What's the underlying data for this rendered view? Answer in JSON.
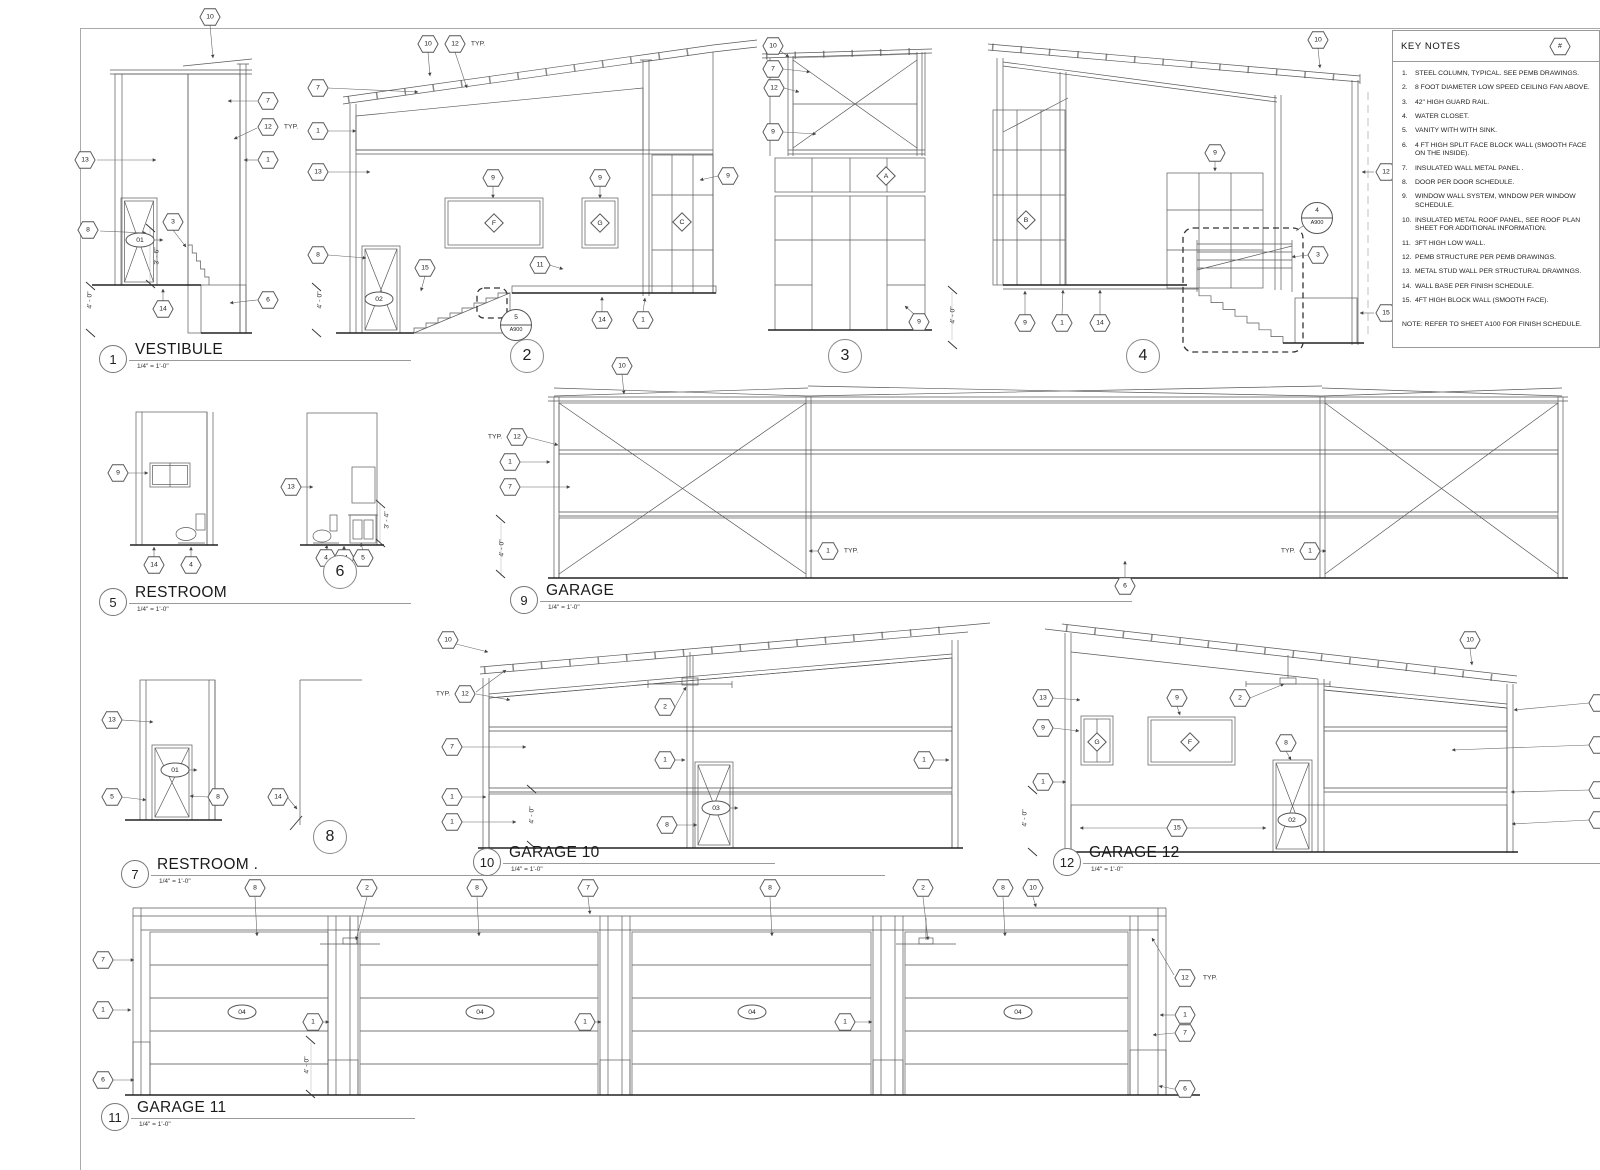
{
  "sheet": {
    "background": "#ffffff",
    "line_color": "#5a5a5a"
  },
  "key_notes": {
    "title": "KEY NOTES",
    "ref_symbol": "#",
    "items": [
      {
        "n": "1.",
        "text": "STEEL COLUMN, TYPICAL. SEE PEMB DRAWINGS."
      },
      {
        "n": "2.",
        "text": "8 FOOT DIAMETER LOW SPEED CEILING FAN ABOVE."
      },
      {
        "n": "3.",
        "text": "42\" HIGH  GUARD RAIL."
      },
      {
        "n": "4.",
        "text": "WATER CLOSET."
      },
      {
        "n": "5.",
        "text": "VANITY WITH WITH SINK."
      },
      {
        "n": "6.",
        "text": "4 FT HIGH SPLIT FACE BLOCK WALL (SMOOTH FACE ON THE INSIDE)."
      },
      {
        "n": "7.",
        "text": "INSULATED WALL METAL PANEL ."
      },
      {
        "n": "8.",
        "text": "DOOR  PER DOOR SCHEDULE."
      },
      {
        "n": "9.",
        "text": "WINDOW WALL SYSTEM, WINDOW PER WINDOW SCHEDULE."
      },
      {
        "n": "10.",
        "text": "INSULATED METAL ROOF PANEL, SEE ROOF PLAN SHEET FOR ADDITIONAL INFORMATION."
      },
      {
        "n": "11.",
        "text": "3FT HIGH LOW WALL."
      },
      {
        "n": "12.",
        "text": "PEMB STRUCTURE PER PEMB DRAWINGS."
      },
      {
        "n": "13.",
        "text": "METAL STUD WALL PER STRUCTURAL DRAWINGS."
      },
      {
        "n": "14.",
        "text": "WALL BASE PER FINISH SCHEDULE."
      },
      {
        "n": "15.",
        "text": "4FT HIGH BLOCK WALL (SMOOTH FACE)."
      }
    ],
    "footnote": "NOTE: REFER TO SHEET A100 FOR FINISH SCHEDULE."
  },
  "titles": [
    {
      "num": "1",
      "label": "VESTIBULE",
      "scale": "1/4\" = 1'-0\"",
      "x": 99,
      "y": 341,
      "w": 312
    },
    {
      "num": "5",
      "label": "RESTROOM",
      "scale": "1/4\" = 1'-0\"",
      "x": 99,
      "y": 584,
      "w": 312
    },
    {
      "num": "7",
      "label": "RESTROOM .",
      "scale": "1/4\" = 1'-0\"",
      "x": 121,
      "y": 856,
      "w": 764
    },
    {
      "num": "9",
      "label": "GARAGE",
      "scale": "1/4\" = 1'-0\"",
      "x": 510,
      "y": 582,
      "w": 622
    },
    {
      "num": "10",
      "label": "GARAGE 10",
      "scale": "1/4\" = 1'-0\"",
      "x": 473,
      "y": 844,
      "w": 302
    },
    {
      "num": "12",
      "label": "GARAGE 12",
      "scale": "1/4\" = 1'-0\"",
      "x": 1053,
      "y": 844,
      "w": 547
    },
    {
      "num": "11",
      "label": "GARAGE 11",
      "scale": "1/4\" = 1'-0\"",
      "x": 101,
      "y": 1099,
      "w": 314
    }
  ],
  "callouts": [
    {
      "num": "2",
      "x": 527,
      "y": 356
    },
    {
      "num": "3",
      "x": 845,
      "y": 356
    },
    {
      "num": "4",
      "x": 1143,
      "y": 356
    },
    {
      "num": "6",
      "x": 340,
      "y": 572
    },
    {
      "num": "8",
      "x": 330,
      "y": 837
    }
  ],
  "drawings": [
    {
      "id": "vestibule-1",
      "tags": [
        {
          "s": "hex",
          "t": "10",
          "x": 210,
          "y": 17
        },
        {
          "s": "hex",
          "t": "7",
          "x": 268,
          "y": 101
        },
        {
          "s": "hex",
          "t": "12",
          "x": 268,
          "y": 127
        },
        {
          "s": "plain",
          "t": "TYP.",
          "x": 291,
          "y": 127
        },
        {
          "s": "hex",
          "t": "1",
          "x": 268,
          "y": 160
        },
        {
          "s": "hex",
          "t": "13",
          "x": 85,
          "y": 160
        },
        {
          "s": "hex",
          "t": "8",
          "x": 88,
          "y": 230
        },
        {
          "s": "oval",
          "t": "01",
          "x": 140,
          "y": 240
        },
        {
          "s": "hex",
          "t": "3",
          "x": 173,
          "y": 222
        },
        {
          "s": "hex",
          "t": "14",
          "x": 163,
          "y": 309
        },
        {
          "s": "hex",
          "t": "6",
          "x": 268,
          "y": 300
        },
        {
          "s": "dim",
          "t": "4' - 0\"",
          "x": 90,
          "y": 300
        },
        {
          "s": "dim",
          "t": "3' - 6\"",
          "x": 157,
          "y": 256
        }
      ]
    },
    {
      "id": "elevation-2",
      "tags": [
        {
          "s": "hex",
          "t": "10",
          "x": 428,
          "y": 44
        },
        {
          "s": "hex",
          "t": "12",
          "x": 455,
          "y": 44
        },
        {
          "s": "plain",
          "t": "TYP.",
          "x": 478,
          "y": 44
        },
        {
          "s": "hex",
          "t": "7",
          "x": 318,
          "y": 88
        },
        {
          "s": "hex",
          "t": "1",
          "x": 318,
          "y": 131
        },
        {
          "s": "hex",
          "t": "13",
          "x": 318,
          "y": 172
        },
        {
          "s": "hex",
          "t": "8",
          "x": 318,
          "y": 255
        },
        {
          "s": "hex",
          "t": "9",
          "x": 493,
          "y": 178
        },
        {
          "s": "hex",
          "t": "9",
          "x": 600,
          "y": 178
        },
        {
          "s": "hex",
          "t": "9",
          "x": 728,
          "y": 176
        },
        {
          "s": "diamond",
          "t": "F",
          "x": 494,
          "y": 223
        },
        {
          "s": "diamond",
          "t": "G",
          "x": 600,
          "y": 223
        },
        {
          "s": "diamond",
          "t": "C",
          "x": 682,
          "y": 222
        },
        {
          "s": "hex",
          "t": "15",
          "x": 425,
          "y": 268
        },
        {
          "s": "hex",
          "t": "11",
          "x": 540,
          "y": 265
        },
        {
          "s": "oval",
          "t": "02",
          "x": 379,
          "y": 299
        },
        {
          "s": "detail",
          "t": "5",
          "sub": "A900",
          "x": 516,
          "y": 325
        },
        {
          "s": "hex",
          "t": "14",
          "x": 602,
          "y": 320
        },
        {
          "s": "hex",
          "t": "1",
          "x": 643,
          "y": 320
        },
        {
          "s": "dim",
          "t": "4' - 0\"",
          "x": 320,
          "y": 300
        }
      ]
    },
    {
      "id": "elevation-3",
      "tags": [
        {
          "s": "hex",
          "t": "10",
          "x": 773,
          "y": 46
        },
        {
          "s": "hex",
          "t": "7",
          "x": 773,
          "y": 69
        },
        {
          "s": "hex",
          "t": "12",
          "x": 774,
          "y": 88
        },
        {
          "s": "hex",
          "t": "9",
          "x": 773,
          "y": 132
        },
        {
          "s": "diamond",
          "t": "A",
          "x": 886,
          "y": 176
        },
        {
          "s": "hex",
          "t": "9",
          "x": 919,
          "y": 322
        }
      ]
    },
    {
      "id": "elevation-4",
      "tags": [
        {
          "s": "hex",
          "t": "10",
          "x": 1318,
          "y": 40
        },
        {
          "s": "hex",
          "t": "9",
          "x": 1215,
          "y": 153
        },
        {
          "s": "diamond",
          "t": "B",
          "x": 1026,
          "y": 220
        },
        {
          "s": "detail",
          "t": "4",
          "sub": "A900",
          "x": 1317,
          "y": 218
        },
        {
          "s": "hex",
          "t": "3",
          "x": 1318,
          "y": 255
        },
        {
          "s": "hex",
          "t": "12",
          "x": 1386,
          "y": 172
        },
        {
          "s": "hex",
          "t": "15",
          "x": 1386,
          "y": 313
        },
        {
          "s": "hex",
          "t": "9",
          "x": 1025,
          "y": 323
        },
        {
          "s": "hex",
          "t": "1",
          "x": 1062,
          "y": 323
        },
        {
          "s": "hex",
          "t": "14",
          "x": 1100,
          "y": 323
        },
        {
          "s": "dim",
          "t": "4' - 0\"",
          "x": 953,
          "y": 315
        }
      ]
    },
    {
      "id": "restroom-5",
      "tags": [
        {
          "s": "hex",
          "t": "9",
          "x": 118,
          "y": 473
        },
        {
          "s": "hex",
          "t": "14",
          "x": 154,
          "y": 565
        },
        {
          "s": "hex",
          "t": "4",
          "x": 191,
          "y": 565
        }
      ]
    },
    {
      "id": "restroom-6",
      "tags": [
        {
          "s": "hex",
          "t": "13",
          "x": 291,
          "y": 487
        },
        {
          "s": "hex",
          "t": "4",
          "x": 326,
          "y": 558
        },
        {
          "s": "hex",
          "t": "14",
          "x": 344,
          "y": 558
        },
        {
          "s": "hex",
          "t": "5",
          "x": 363,
          "y": 558
        },
        {
          "s": "dim",
          "t": "3' - 4\"",
          "x": 387,
          "y": 520
        }
      ]
    },
    {
      "id": "restroom-7",
      "tags": [
        {
          "s": "hex",
          "t": "13",
          "x": 112,
          "y": 720
        },
        {
          "s": "oval",
          "t": "01",
          "x": 175,
          "y": 770
        },
        {
          "s": "hex",
          "t": "5",
          "x": 112,
          "y": 797
        },
        {
          "s": "hex",
          "t": "8",
          "x": 218,
          "y": 797
        }
      ]
    },
    {
      "id": "elevation-8",
      "tags": [
        {
          "s": "hex",
          "t": "14",
          "x": 278,
          "y": 797
        }
      ]
    },
    {
      "id": "garage-9",
      "tags": [
        {
          "s": "hex",
          "t": "10",
          "x": 622,
          "y": 366
        },
        {
          "s": "plain",
          "t": "TYP.",
          "x": 495,
          "y": 437
        },
        {
          "s": "hex",
          "t": "12",
          "x": 517,
          "y": 437
        },
        {
          "s": "hex",
          "t": "1",
          "x": 510,
          "y": 462
        },
        {
          "s": "hex",
          "t": "7",
          "x": 510,
          "y": 487
        },
        {
          "s": "hex",
          "t": "1",
          "x": 828,
          "y": 551
        },
        {
          "s": "plain",
          "t": "TYP.",
          "x": 851,
          "y": 551
        },
        {
          "s": "plain",
          "t": "TYP.",
          "x": 1288,
          "y": 551
        },
        {
          "s": "hex",
          "t": "1",
          "x": 1310,
          "y": 551
        },
        {
          "s": "hex",
          "t": "6",
          "x": 1125,
          "y": 586
        },
        {
          "s": "dim",
          "t": "4' - 0\"",
          "x": 502,
          "y": 548
        }
      ]
    },
    {
      "id": "garage-10",
      "tags": [
        {
          "s": "hex",
          "t": "10",
          "x": 448,
          "y": 640
        },
        {
          "s": "plain",
          "t": "TYP.",
          "x": 443,
          "y": 694
        },
        {
          "s": "hex",
          "t": "12",
          "x": 465,
          "y": 694
        },
        {
          "s": "hex",
          "t": "7",
          "x": 452,
          "y": 747
        },
        {
          "s": "hex",
          "t": "1",
          "x": 452,
          "y": 797
        },
        {
          "s": "hex",
          "t": "1",
          "x": 452,
          "y": 822
        },
        {
          "s": "hex",
          "t": "2",
          "x": 665,
          "y": 707
        },
        {
          "s": "hex",
          "t": "1",
          "x": 665,
          "y": 760
        },
        {
          "s": "oval",
          "t": "03",
          "x": 716,
          "y": 808
        },
        {
          "s": "hex",
          "t": "8",
          "x": 667,
          "y": 825
        },
        {
          "s": "hex",
          "t": "1",
          "x": 924,
          "y": 760
        },
        {
          "s": "dim",
          "t": "4' - 0\"",
          "x": 532,
          "y": 815
        }
      ]
    },
    {
      "id": "garage-12",
      "tags": [
        {
          "s": "hex",
          "t": "13",
          "x": 1043,
          "y": 698
        },
        {
          "s": "hex",
          "t": "9",
          "x": 1043,
          "y": 728
        },
        {
          "s": "hex",
          "t": "9",
          "x": 1177,
          "y": 698
        },
        {
          "s": "hex",
          "t": "2",
          "x": 1240,
          "y": 698
        },
        {
          "s": "diamond",
          "t": "G",
          "x": 1097,
          "y": 742
        },
        {
          "s": "diamond",
          "t": "F",
          "x": 1190,
          "y": 742
        },
        {
          "s": "hex",
          "t": "8",
          "x": 1286,
          "y": 743
        },
        {
          "s": "oval",
          "t": "02",
          "x": 1292,
          "y": 820
        },
        {
          "s": "hex",
          "t": "1",
          "x": 1043,
          "y": 782
        },
        {
          "s": "hex",
          "t": "15",
          "x": 1177,
          "y": 828
        },
        {
          "s": "hex",
          "t": "10",
          "x": 1470,
          "y": 640
        },
        {
          "s": "hex",
          "t": "",
          "x": 1599,
          "y": 703
        },
        {
          "s": "hex",
          "t": "",
          "x": 1599,
          "y": 745
        },
        {
          "s": "hex",
          "t": "",
          "x": 1599,
          "y": 790
        },
        {
          "s": "hex",
          "t": "",
          "x": 1599,
          "y": 820
        },
        {
          "s": "dim",
          "t": "4' - 0\"",
          "x": 1025,
          "y": 818
        }
      ]
    },
    {
      "id": "garage-11",
      "tags": [
        {
          "s": "hex",
          "t": "8",
          "x": 255,
          "y": 888
        },
        {
          "s": "hex",
          "t": "2",
          "x": 367,
          "y": 888
        },
        {
          "s": "hex",
          "t": "8",
          "x": 477,
          "y": 888
        },
        {
          "s": "hex",
          "t": "7",
          "x": 588,
          "y": 888
        },
        {
          "s": "hex",
          "t": "8",
          "x": 770,
          "y": 888
        },
        {
          "s": "hex",
          "t": "2",
          "x": 923,
          "y": 888
        },
        {
          "s": "hex",
          "t": "8",
          "x": 1003,
          "y": 888
        },
        {
          "s": "hex",
          "t": "10",
          "x": 1033,
          "y": 888
        },
        {
          "s": "hex",
          "t": "7",
          "x": 103,
          "y": 960
        },
        {
          "s": "hex",
          "t": "1",
          "x": 103,
          "y": 1010
        },
        {
          "s": "hex",
          "t": "6",
          "x": 103,
          "y": 1080
        },
        {
          "s": "hex",
          "t": "1",
          "x": 313,
          "y": 1022
        },
        {
          "s": "hex",
          "t": "1",
          "x": 585,
          "y": 1022
        },
        {
          "s": "hex",
          "t": "1",
          "x": 845,
          "y": 1022
        },
        {
          "s": "oval",
          "t": "04",
          "x": 242,
          "y": 1012
        },
        {
          "s": "oval",
          "t": "04",
          "x": 480,
          "y": 1012
        },
        {
          "s": "oval",
          "t": "04",
          "x": 752,
          "y": 1012
        },
        {
          "s": "oval",
          "t": "04",
          "x": 1018,
          "y": 1012
        },
        {
          "s": "hex",
          "t": "12",
          "x": 1185,
          "y": 978
        },
        {
          "s": "plain",
          "t": "TYP.",
          "x": 1210,
          "y": 978
        },
        {
          "s": "hex",
          "t": "1",
          "x": 1185,
          "y": 1015
        },
        {
          "s": "hex",
          "t": "7",
          "x": 1185,
          "y": 1033
        },
        {
          "s": "hex",
          "t": "6",
          "x": 1185,
          "y": 1089
        },
        {
          "s": "dim",
          "t": "4' - 0\"",
          "x": 307,
          "y": 1065
        }
      ]
    }
  ]
}
